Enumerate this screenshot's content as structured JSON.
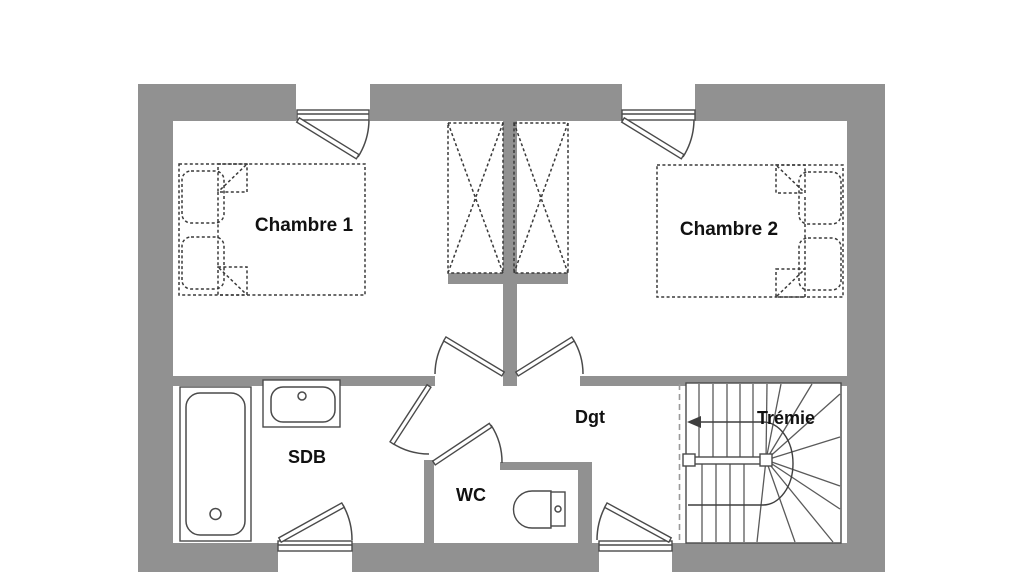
{
  "plan_type": "floor-plan",
  "labels": {
    "chambre1": "Chambre 1",
    "chambre2": "Chambre 2",
    "sdb": "SDB",
    "wc": "WC",
    "dgt": "Dgt",
    "tremie": "Trémie"
  },
  "colors": {
    "background": "#ffffff",
    "wall": "#919191",
    "outline": "#4a4a4a",
    "dashed": "#3a3a3a",
    "text": "#111111"
  },
  "symbols": {
    "beds": "double-bed-dashed",
    "wardrobes": "wardrobe-cross-dashed",
    "bathtub": "bathtub",
    "sink": "washbasin",
    "toilet": "toilet",
    "stairs": "winder-staircase",
    "arrow": "stair-direction-arrow",
    "doors": "quarter-swing-door",
    "windows": "casement-window"
  }
}
